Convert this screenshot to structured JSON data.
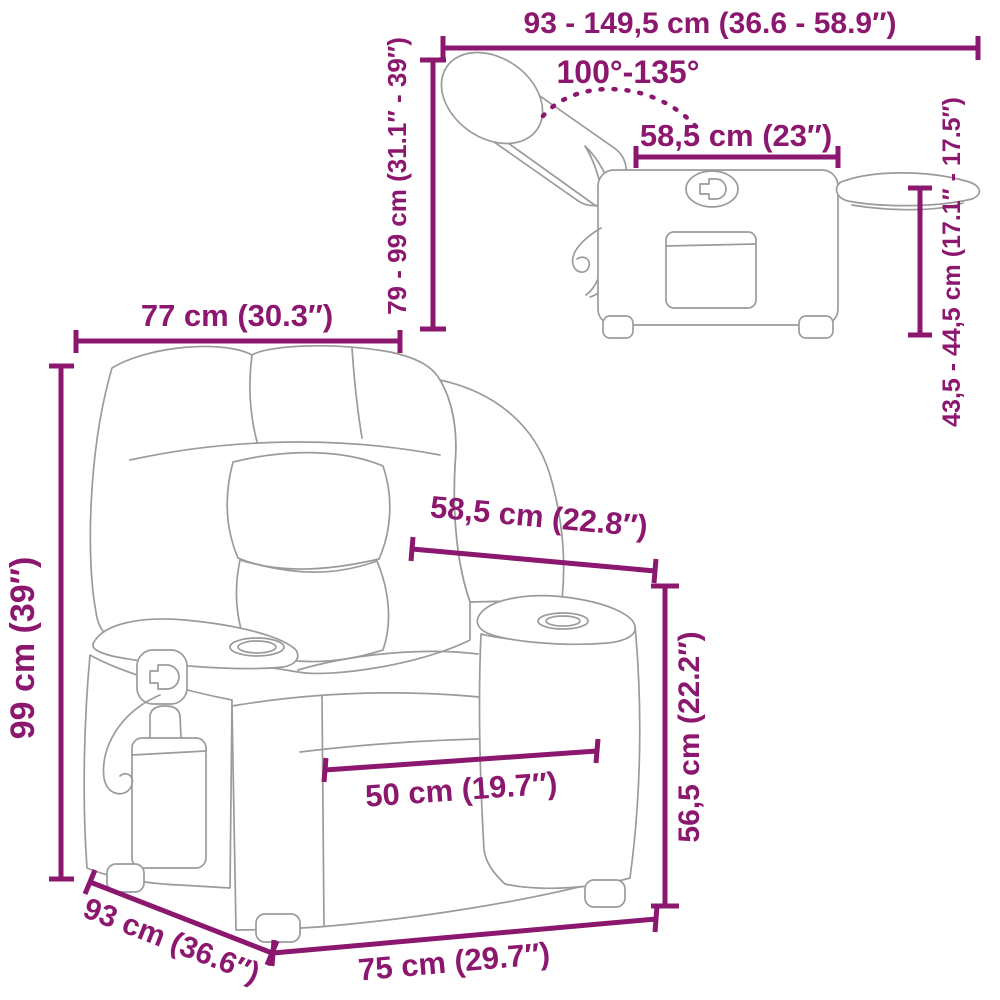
{
  "colors": {
    "dimension": "#8C176E",
    "artwork": "#9B9B9B",
    "background": "#FFFFFF"
  },
  "diagram_type": "recliner-chair-dimension-diagram",
  "labels": {
    "top_width_range": "93 - 149,5 cm (36.6 - 58.9″)",
    "recline_angle": "100°-135°",
    "seat_top_depth": "58,5 cm (23″)",
    "footrest_floor_height": "43,5 - 44,5 cm (17.1″ - 17.5″)",
    "backrest_height_range": "79 - 99 cm (31.1″ - 39″)",
    "overall_width": "77 cm (30.3″)",
    "overall_height": "99 cm (39″)",
    "seat_top_width": "58,5 cm (22.8″)",
    "armrest_height": "56,5 cm (22.2″)",
    "seat_front_width": "50 cm (19.7″)",
    "overall_depth": "93 cm (36.6″)",
    "base_front_width": "75 cm (29.7″)"
  }
}
